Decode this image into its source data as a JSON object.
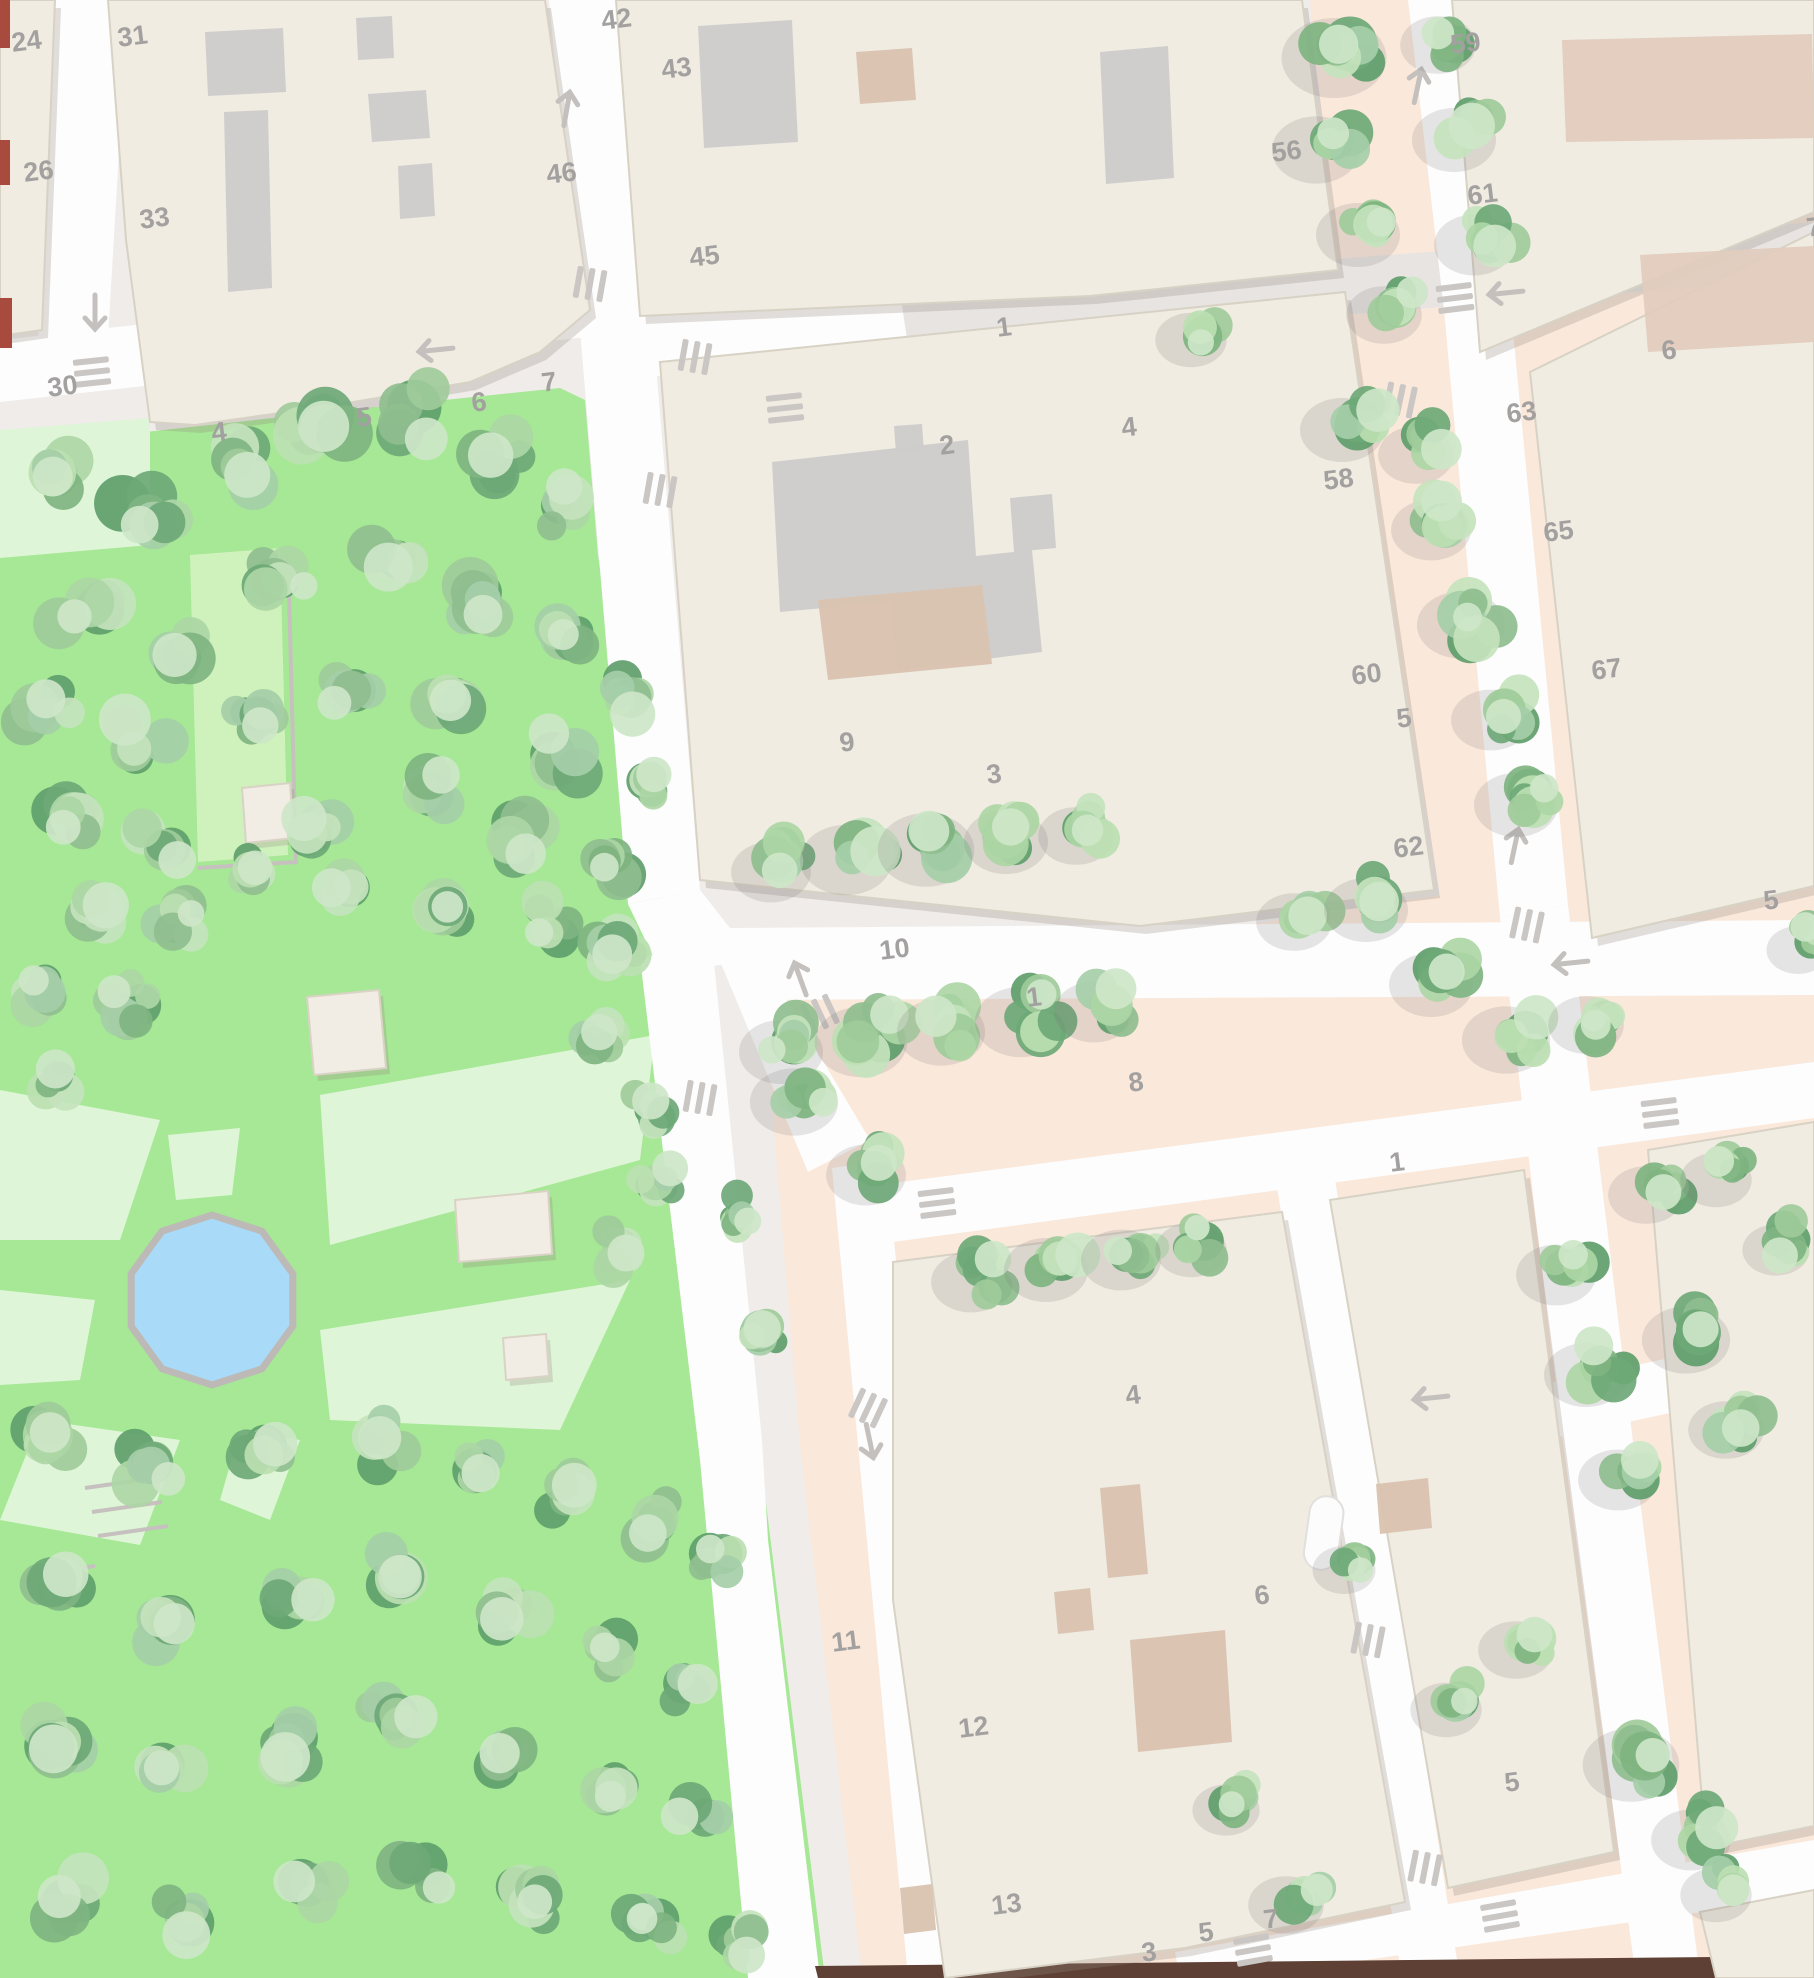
{
  "map": {
    "width": 1814,
    "height": 1978,
    "colors": {
      "base": "#EFECEA",
      "peach": "#FAE8DB",
      "park": "#A6E895",
      "lawn": "#DFF5D8",
      "lawn_bright": "#CFF2BC",
      "street_white": "#FDFDFD",
      "street_gray": "#E7E4E2",
      "building": "#F0ECE2",
      "building_stroke": "#D8D2C5",
      "courtyard": "#CDCCCB",
      "tan": "#D9C3AF",
      "brown_block": "#E2CCBE",
      "pond_fill": "#A9DAF8",
      "pond_rim": "#BDB9B7",
      "label": "#A3A0A0",
      "marking": "#C9C6C4",
      "red_mark": "#A84A3E",
      "dark_strip": "#5E4034",
      "shadow": "rgba(150,140,130,0.28)",
      "tree_shadow": "rgba(120,118,115,0.18)",
      "tree_palette": [
        "#8FBE8F",
        "#9FCB9A",
        "#ADD6A5",
        "#BCDFB2",
        "#7FB481",
        "#A5CEA8",
        "#C4E3BD",
        "#6EA877"
      ],
      "tree_highlight": "#CDE6C8",
      "tree_dark": "#5F9E6B",
      "path_gray": "#C6C1BE"
    },
    "peach_zone": "1310,0 1814,0 1814,1978 862,1978 800,1445 762,985 1150,940 1440,895 1336,272",
    "park_zone": "0,448 300,415 560,388 585,400 598,555 645,868 700,948 705,1150 760,1455 825,1978 0,1978",
    "lawns": [
      {
        "pts": "190,555 280,548 288,855 198,862",
        "bright": true
      },
      {
        "pts": "0,430 150,418 150,545 0,558",
        "bright": false
      },
      {
        "pts": "0,1090 160,1120 120,1240 0,1240",
        "bright": false
      },
      {
        "pts": "168,1135 240,1128 232,1195 176,1200",
        "bright": false
      },
      {
        "pts": "320,1095 655,1035 640,1160 330,1245",
        "bright": false
      },
      {
        "pts": "320,1330 630,1280 560,1430 330,1420",
        "bright": false
      },
      {
        "pts": "0,1290 95,1300 80,1380 0,1385",
        "bright": false
      },
      {
        "pts": "40,1420 180,1440 140,1545 0,1520",
        "bright": false
      },
      {
        "pts": "240,1430 300,1440 270,1520 220,1500",
        "bright": false
      }
    ],
    "streets_gray": [
      "860,296 1814,222 1814,278 866,352"
    ],
    "streets_white": [
      "55,0 128,0 108,338 38,346",
      "0,340 585,275 596,336 0,402",
      "549,0 622,0 652,318 580,330",
      "580,330 652,318 700,890 628,904",
      "628,904 700,890 730,928 748,960 662,975",
      "640,958 712,942 762,1440 768,1540 820,1978 748,1978 700,1460",
      "712,942 748,935 870,1140 808,1172",
      "832,1168 886,1160 968,1978 908,1978",
      "840,1190 1814,1062 1814,1118 848,1248",
      "730,928 1814,920 1814,995 742,1000",
      "600,322 900,292 908,346 610,382",
      "1408,0 1472,0 1510,300 1444,310",
      "1444,310 1510,300 1568,905 1500,918",
      "1500,918 1568,905 1640,1500 1700,1978 1636,1978 1560,1420",
      "1300,1435 1814,1328 1814,1382 1312,1490",
      "1272,1155 1330,1147 1448,1905 1460,1978 1402,1978 1330,1520",
      "1175,1952 1814,1840 1814,1896 1240,1978 1180,1978"
    ],
    "dark_strip": "815,1966 1814,1956 1814,1978 818,1978",
    "blocks": [
      {
        "pts": "0,0 55,0 42,330 0,336"
      },
      {
        "pts": "108,0 545,0 590,310 540,352 470,382 330,406 195,425 150,422 126,240"
      },
      {
        "pts": "616,0 1302,0 1338,270 1090,296 640,316"
      },
      {
        "pts": "660,362 1345,292 1434,890 1140,926 700,880"
      },
      {
        "pts": "1452,0 1814,0 1814,212 1480,352"
      },
      {
        "pts": "1530,372 1814,232 1814,886 1592,938"
      },
      {
        "pts": "893,1262 1282,1212 1405,1902 1185,1948 945,1978 893,1600"
      },
      {
        "pts": "1330,1200 1524,1170 1614,1852 1448,1888"
      },
      {
        "pts": "1648,1150 1814,1122 1814,1826 1706,1848"
      },
      {
        "pts": "1700,1912 1814,1890 1814,1978 1716,1978"
      }
    ],
    "courtyards": [
      {
        "pts": "205,32 283,28 286,92 208,96",
        "fill": "courtyard"
      },
      {
        "pts": "224,112 268,110 272,288 228,292",
        "fill": "courtyard"
      },
      {
        "pts": "356,18 392,16 394,58 358,60",
        "fill": "courtyard"
      },
      {
        "pts": "368,94 426,90 430,138 372,142",
        "fill": "courtyard"
      },
      {
        "pts": "398,166 432,163 435,216 400,219",
        "fill": "courtyard"
      },
      {
        "pts": "698,26 792,20 798,142 704,148",
        "fill": "courtyard"
      },
      {
        "pts": "856,52 912,48 916,100 860,104",
        "fill": "tan"
      },
      {
        "pts": "1100,52 1168,46 1174,178 1106,184",
        "fill": "courtyard"
      },
      {
        "pts": "772,462 968,440 976,556 1032,550 1042,652 898,670 890,602 780,612",
        "fill": "courtyard"
      },
      {
        "pts": "818,600 982,585 992,664 828,680",
        "fill": "tan"
      },
      {
        "pts": "1010,498 1052,494 1056,548 1014,552",
        "fill": "courtyard"
      },
      {
        "pts": "894,426 922,424 924,452 896,454",
        "fill": "courtyard"
      },
      {
        "pts": "1562,40 1812,34 1814,138 1566,142",
        "fill": "brown_block"
      },
      {
        "pts": "1640,255 1814,246 1814,342 1648,352",
        "fill": "brown_block"
      },
      {
        "pts": "1100,1488 1140,1484 1148,1574 1108,1578",
        "fill": "tan"
      },
      {
        "pts": "1130,1640 1225,1630 1232,1742 1138,1752",
        "fill": "tan"
      },
      {
        "pts": "1054,1592 1090,1588 1094,1630 1058,1634",
        "fill": "tan"
      },
      {
        "pts": "1376,1484 1428,1478 1432,1528 1380,1534",
        "fill": "tan"
      },
      {
        "pts": "900,1888 932,1884 936,1930 904,1934",
        "fill": "tan"
      }
    ],
    "pill": {
      "x": 1312,
      "y": 1494,
      "w": 34,
      "h": 74,
      "r": 17
    },
    "pavilions": [
      {
        "pts": "242,788 290,783 294,838 246,843"
      },
      {
        "pts": "307,997 379,990 386,1068 314,1075"
      },
      {
        "pts": "455,1200 548,1191 552,1254 459,1262"
      },
      {
        "pts": "503,1338 546,1334 549,1376 506,1380"
      }
    ],
    "pond": {
      "cx": 212,
      "cy": 1300,
      "points": "292.8,1273.7 262,1231.2 212,1215 162,1231.2 131.2,1273.7 131.2,1326.3 162,1368.8 212,1385 262,1368.8 292.8,1326.3"
    },
    "paths": [
      "288,555 296,862 198,868",
      "85,1488 155,1478",
      "92,1512 162,1502",
      "98,1536 168,1526",
      "55,1572 95,1566"
    ],
    "red_marks": [
      {
        "x": 0,
        "y": 0,
        "w": 10,
        "h": 48
      },
      {
        "x": 0,
        "y": 140,
        "w": 10,
        "h": 45
      },
      {
        "x": 0,
        "y": 298,
        "w": 12,
        "h": 50
      }
    ],
    "arrows": [
      {
        "x": 95,
        "y": 313,
        "rot": 180
      },
      {
        "x": 567,
        "y": 108,
        "rot": 10
      },
      {
        "x": 435,
        "y": 350,
        "rot": 264
      },
      {
        "x": 1418,
        "y": 85,
        "rot": 12
      },
      {
        "x": 1505,
        "y": 293,
        "rot": 264
      },
      {
        "x": 800,
        "y": 978,
        "rot": -20
      },
      {
        "x": 870,
        "y": 1442,
        "rot": 168
      },
      {
        "x": 1515,
        "y": 845,
        "rot": 12
      },
      {
        "x": 1570,
        "y": 963,
        "rot": 264
      },
      {
        "x": 1430,
        "y": 1398,
        "rot": 264
      }
    ],
    "crossings": [
      {
        "x": 590,
        "y": 284,
        "rot": 10,
        "v": true
      },
      {
        "x": 695,
        "y": 357,
        "rot": 10,
        "v": true
      },
      {
        "x": 92,
        "y": 372,
        "rot": -6,
        "v": false
      },
      {
        "x": 785,
        "y": 408,
        "rot": -6,
        "v": false
      },
      {
        "x": 660,
        "y": 490,
        "rot": 10,
        "v": true
      },
      {
        "x": 1400,
        "y": 400,
        "rot": 12,
        "v": true
      },
      {
        "x": 1455,
        "y": 298,
        "rot": -7,
        "v": false
      },
      {
        "x": 937,
        "y": 1203,
        "rot": -7,
        "v": false
      },
      {
        "x": 1660,
        "y": 1113,
        "rot": -7,
        "v": false
      },
      {
        "x": 820,
        "y": 1014,
        "rot": -25,
        "v": true
      },
      {
        "x": 1527,
        "y": 925,
        "rot": 12,
        "v": true
      },
      {
        "x": 868,
        "y": 1408,
        "rot": 25,
        "v": true
      },
      {
        "x": 700,
        "y": 1098,
        "rot": 10,
        "v": true
      },
      {
        "x": 1368,
        "y": 1640,
        "rot": 11,
        "v": true
      },
      {
        "x": 1425,
        "y": 1868,
        "rot": 11,
        "v": true
      },
      {
        "x": 1253,
        "y": 1950,
        "rot": -10,
        "v": false
      },
      {
        "x": 1500,
        "y": 1916,
        "rot": -10,
        "v": false
      }
    ],
    "house_numbers": [
      {
        "t": "24",
        "x": 10,
        "y": 30
      },
      {
        "t": "26",
        "x": 22,
        "y": 160
      },
      {
        "t": "30",
        "x": 46,
        "y": 375
      },
      {
        "t": "31",
        "x": 116,
        "y": 25
      },
      {
        "t": "33",
        "x": 138,
        "y": 207
      },
      {
        "t": "42",
        "x": 600,
        "y": 8
      },
      {
        "t": "43",
        "x": 660,
        "y": 57
      },
      {
        "t": "46",
        "x": 545,
        "y": 162
      },
      {
        "t": "45",
        "x": 688,
        "y": 245
      },
      {
        "t": "4",
        "x": 210,
        "y": 420
      },
      {
        "t": "5",
        "x": 355,
        "y": 405
      },
      {
        "t": "6",
        "x": 470,
        "y": 390
      },
      {
        "t": "7",
        "x": 540,
        "y": 370
      },
      {
        "t": "1",
        "x": 995,
        "y": 315
      },
      {
        "t": "2",
        "x": 938,
        "y": 433
      },
      {
        "t": "4",
        "x": 1120,
        "y": 415
      },
      {
        "t": "56",
        "x": 1270,
        "y": 140
      },
      {
        "t": "58",
        "x": 1322,
        "y": 468
      },
      {
        "t": "59",
        "x": 1449,
        "y": 32
      },
      {
        "t": "60",
        "x": 1350,
        "y": 663
      },
      {
        "t": "61",
        "x": 1466,
        "y": 183
      },
      {
        "t": "62",
        "x": 1392,
        "y": 836
      },
      {
        "t": "63",
        "x": 1505,
        "y": 401
      },
      {
        "t": "65",
        "x": 1542,
        "y": 520
      },
      {
        "t": "67",
        "x": 1590,
        "y": 658
      },
      {
        "t": "5",
        "x": 1762,
        "y": 888
      },
      {
        "t": "6",
        "x": 1660,
        "y": 338
      },
      {
        "t": "7",
        "x": 1805,
        "y": 215
      },
      {
        "t": "9",
        "x": 838,
        "y": 730
      },
      {
        "t": "10",
        "x": 878,
        "y": 938
      },
      {
        "t": "1",
        "x": 1025,
        "y": 985
      },
      {
        "t": "3",
        "x": 985,
        "y": 762
      },
      {
        "t": "8",
        "x": 1127,
        "y": 1070
      },
      {
        "t": "1",
        "x": 1388,
        "y": 1150
      },
      {
        "t": "4",
        "x": 1124,
        "y": 1383
      },
      {
        "t": "6",
        "x": 1253,
        "y": 1583
      },
      {
        "t": "11",
        "x": 830,
        "y": 1630
      },
      {
        "t": "12",
        "x": 957,
        "y": 1716
      },
      {
        "t": "13",
        "x": 990,
        "y": 1893
      },
      {
        "t": "3",
        "x": 1140,
        "y": 1940
      },
      {
        "t": "5",
        "x": 1197,
        "y": 1920
      },
      {
        "t": "7",
        "x": 1262,
        "y": 1907
      },
      {
        "t": "5",
        "x": 1503,
        "y": 1770
      },
      {
        "t": "5",
        "x": 1395,
        "y": 706
      }
    ],
    "trees": [
      [
        55,
        475,
        48
      ],
      [
        145,
        515,
        52
      ],
      [
        235,
        465,
        44
      ],
      [
        325,
        425,
        50
      ],
      [
        415,
        415,
        52
      ],
      [
        495,
        455,
        46
      ],
      [
        560,
        505,
        42
      ],
      [
        80,
        610,
        50
      ],
      [
        175,
        655,
        46
      ],
      [
        280,
        580,
        40
      ],
      [
        390,
        560,
        46
      ],
      [
        480,
        610,
        50
      ],
      [
        565,
        640,
        44
      ],
      [
        45,
        715,
        44
      ],
      [
        140,
        745,
        48
      ],
      [
        255,
        720,
        38
      ],
      [
        350,
        690,
        42
      ],
      [
        455,
        700,
        46
      ],
      [
        560,
        755,
        44
      ],
      [
        620,
        700,
        40
      ],
      [
        70,
        815,
        46
      ],
      [
        160,
        845,
        42
      ],
      [
        320,
        825,
        40
      ],
      [
        425,
        795,
        44
      ],
      [
        520,
        845,
        46
      ],
      [
        605,
        860,
        40
      ],
      [
        650,
        790,
        34
      ],
      [
        255,
        875,
        36
      ],
      [
        350,
        890,
        40
      ],
      [
        450,
        905,
        42
      ],
      [
        545,
        925,
        40
      ],
      [
        615,
        950,
        38
      ],
      [
        90,
        905,
        42
      ],
      [
        180,
        915,
        38
      ],
      [
        45,
        985,
        40
      ],
      [
        130,
        1005,
        36
      ],
      [
        600,
        1030,
        40
      ],
      [
        650,
        1105,
        36
      ],
      [
        60,
        1080,
        34
      ],
      [
        660,
        1185,
        34
      ],
      [
        620,
        1250,
        36
      ],
      [
        45,
        1435,
        46
      ],
      [
        150,
        1465,
        42
      ],
      [
        265,
        1445,
        40
      ],
      [
        375,
        1440,
        46
      ],
      [
        475,
        1470,
        42
      ],
      [
        570,
        1495,
        40
      ],
      [
        655,
        1520,
        42
      ],
      [
        715,
        1560,
        36
      ],
      [
        60,
        1590,
        48
      ],
      [
        170,
        1620,
        44
      ],
      [
        290,
        1595,
        40
      ],
      [
        400,
        1575,
        46
      ],
      [
        505,
        1615,
        42
      ],
      [
        610,
        1650,
        40
      ],
      [
        690,
        1685,
        36
      ],
      [
        50,
        1745,
        50
      ],
      [
        165,
        1770,
        44
      ],
      [
        285,
        1745,
        46
      ],
      [
        395,
        1715,
        42
      ],
      [
        505,
        1755,
        40
      ],
      [
        610,
        1785,
        42
      ],
      [
        700,
        1815,
        38
      ],
      [
        65,
        1900,
        46
      ],
      [
        185,
        1915,
        42
      ],
      [
        305,
        1885,
        40
      ],
      [
        425,
        1865,
        46
      ],
      [
        540,
        1895,
        42
      ],
      [
        650,
        1925,
        40
      ],
      [
        745,
        1945,
        34
      ],
      [
        760,
        1330,
        34
      ],
      [
        740,
        1215,
        32
      ],
      [
        1348,
        48,
        50,
        1
      ],
      [
        1330,
        140,
        42,
        1
      ],
      [
        1372,
        225,
        40,
        1
      ],
      [
        1398,
        305,
        36,
        1
      ],
      [
        1452,
        35,
        36,
        1
      ],
      [
        1468,
        130,
        40,
        1
      ],
      [
        1488,
        235,
        38,
        1
      ],
      [
        1356,
        420,
        40,
        1
      ],
      [
        1430,
        445,
        36,
        1
      ],
      [
        1445,
        520,
        38,
        1
      ],
      [
        1475,
        615,
        42,
        1
      ],
      [
        1505,
        710,
        38,
        1
      ],
      [
        1530,
        795,
        40,
        1
      ],
      [
        1205,
        330,
        34,
        1
      ],
      [
        785,
        862,
        38,
        1
      ],
      [
        860,
        850,
        44,
        1
      ],
      [
        940,
        840,
        46,
        1
      ],
      [
        1020,
        832,
        40,
        1
      ],
      [
        1090,
        826,
        36,
        1
      ],
      [
        1308,
        912,
        36,
        1
      ],
      [
        1380,
        900,
        40,
        1
      ],
      [
        795,
        1042,
        40,
        1
      ],
      [
        875,
        1032,
        44,
        1
      ],
      [
        955,
        1022,
        42,
        1
      ],
      [
        1035,
        1012,
        44,
        1
      ],
      [
        1108,
        1002,
        38,
        1
      ],
      [
        1445,
        975,
        40,
        1
      ],
      [
        1520,
        1030,
        42,
        1
      ],
      [
        1600,
        1015,
        36,
        1
      ],
      [
        985,
        1272,
        38,
        1
      ],
      [
        1060,
        1260,
        40,
        1
      ],
      [
        1135,
        1250,
        38,
        1
      ],
      [
        1205,
        1240,
        34,
        1
      ],
      [
        1660,
        1185,
        36,
        1
      ],
      [
        1730,
        1170,
        34,
        1
      ],
      [
        1570,
        1265,
        38,
        1
      ],
      [
        1600,
        1365,
        40,
        1
      ],
      [
        1632,
        1470,
        38,
        1
      ],
      [
        1700,
        1330,
        42,
        1
      ],
      [
        1740,
        1420,
        36,
        1
      ],
      [
        1530,
        1640,
        36,
        1
      ],
      [
        1645,
        1755,
        46,
        1
      ],
      [
        1705,
        1830,
        38,
        1
      ],
      [
        1730,
        1885,
        34,
        1
      ],
      [
        1300,
        1895,
        36,
        1
      ],
      [
        1240,
        1800,
        32,
        1
      ],
      [
        1358,
        1560,
        30,
        1
      ],
      [
        1460,
        1700,
        34,
        1
      ],
      [
        808,
        1092,
        42,
        1
      ],
      [
        880,
        1165,
        38,
        1
      ],
      [
        1812,
        940,
        30,
        1
      ],
      [
        1790,
        1240,
        32,
        1
      ]
    ]
  }
}
